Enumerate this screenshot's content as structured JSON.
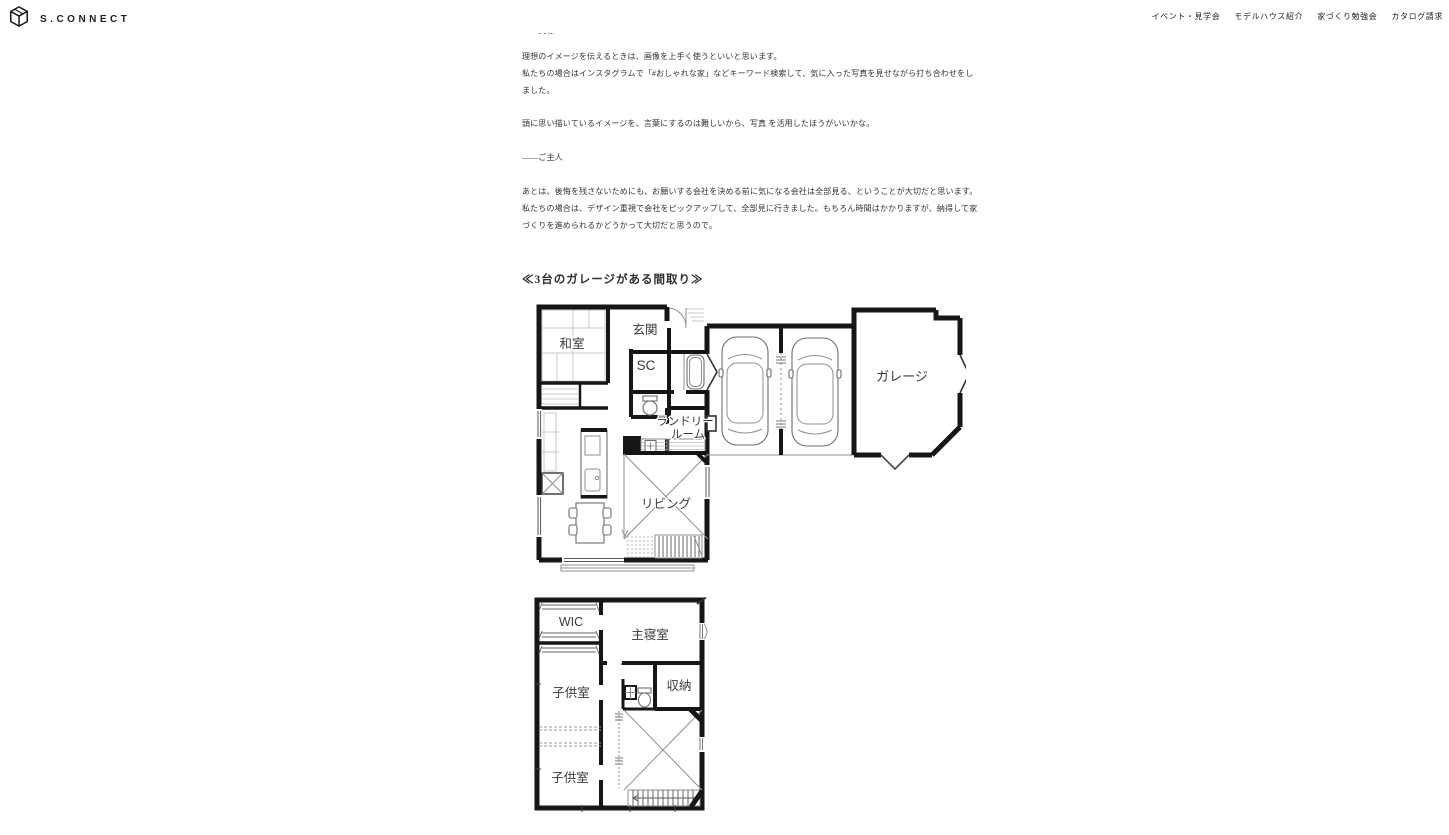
{
  "header": {
    "logo_text": "S.CONNECT",
    "nav": [
      {
        "label": "イベント・見学会"
      },
      {
        "label": "モデルハウス紹介"
      },
      {
        "label": "家づくり勉強会"
      },
      {
        "label": "カタログ請求"
      }
    ]
  },
  "article": {
    "tagline_wife": "――奥様",
    "paragraphs": [
      "理想のイメージを伝えるときは、画像を上手く使うといいと思います。",
      "私たちの場合はインスタグラムで「#おしゃれな家」などキーワード検索して、気に入った写真を見せながら打ち合わせをしました。",
      "頭に思い描いているイメージを、言葉にするのは難しいから、写真 を活用したほうがいいかな。",
      "――ご主人",
      "あとは、後悔を残さないためにも、お願いする会社を決める前に気になる会社は全部見る、ということが大切だと思います。",
      "私たちの場合は、デザイン重視で会社をピックアップして、全部見に行きました。もちろん時間はかかりますが、納得して家づくりを進められるかどうかって大切だと思うので。"
    ],
    "heading": "≪3台のガレージがある間取り≫"
  },
  "floorplan_1f": {
    "rooms": {
      "washitsu": "和室",
      "genkan": "玄関",
      "shoes_closet": "SC",
      "laundry_line1": "ランドリー",
      "laundry_line2": "ルーム",
      "living": "リビング",
      "garage": "ガレージ"
    }
  },
  "floorplan_2f": {
    "rooms": {
      "wic": "WIC",
      "master_bedroom": "主寝室",
      "kids_room_1": "子供室",
      "storage": "収納",
      "kids_room_2": "子供室"
    }
  },
  "colors": {
    "text": "#333333",
    "wall": "#161616",
    "background": "#ffffff"
  }
}
